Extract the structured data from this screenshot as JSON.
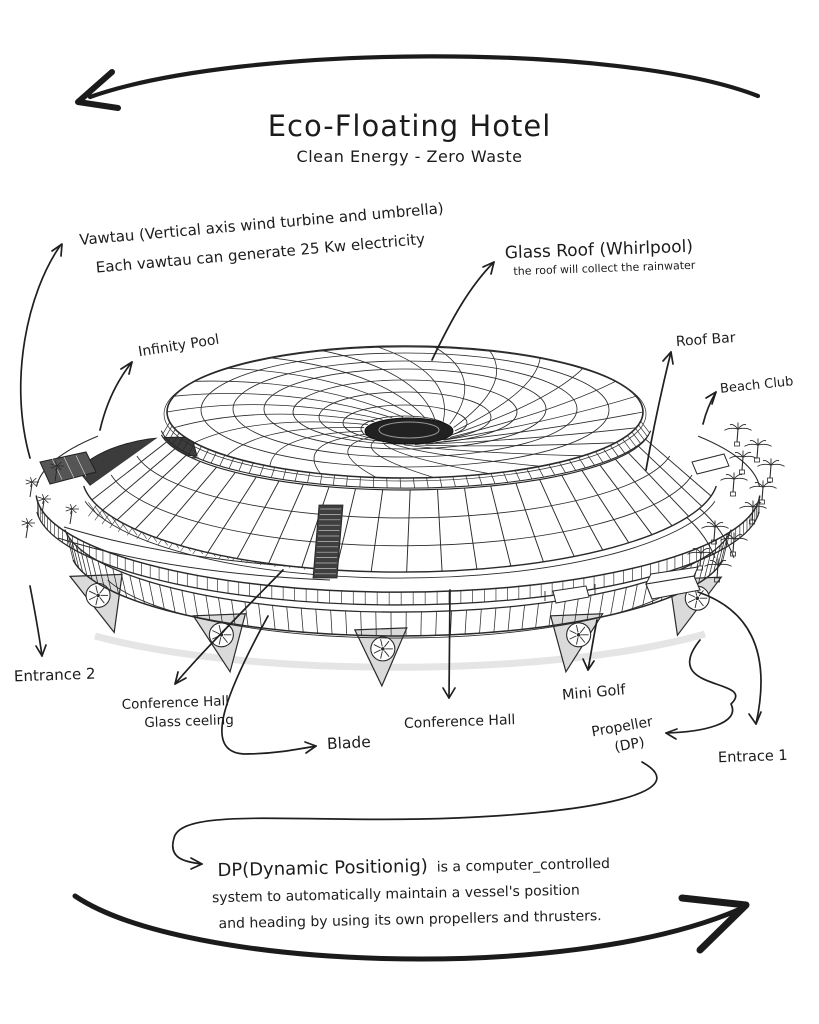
{
  "colors": {
    "ink": "#1c1c1c",
    "paper": "#ffffff",
    "dark_shade": "#3c3c3c"
  },
  "header": {
    "title": "Eco-Floating Hotel",
    "subtitle": "Clean Energy - Zero Waste"
  },
  "annotations": {
    "vawtau": {
      "line1": "Vawtau (Vertical axis wind turbine and umbrella)",
      "line2": "Each vawtau can generate 25 Kw electricity"
    },
    "glass_roof": {
      "label": "Glass Roof (Whirlpool)",
      "note": "the roof will collect the rainwater"
    },
    "infinity_pool": {
      "label": "Infinity Pool"
    },
    "roof_bar": {
      "label": "Roof Bar"
    },
    "beach_club": {
      "label": "Beach Club"
    },
    "entrance_2": {
      "label": "Entrance 2"
    },
    "conference_hall_glass": {
      "line1": "Conference Hall",
      "line2": "Glass ceeling"
    },
    "blade": {
      "label": "Blade"
    },
    "conference_hall": {
      "label": "Conference Hall"
    },
    "mini_golf": {
      "label": "Mini Golf"
    },
    "propeller": {
      "line1": "Propeller",
      "line2": "(DP)"
    },
    "entrance_1": {
      "label": "Entrace 1"
    },
    "dp_note": {
      "intro": "DP(Dynamic Positionig)",
      "line1_rest": "is a computer_controlled",
      "line2": "system to automatically maintain a vessel's position",
      "line3": "and heading by using its own propellers and thrusters."
    }
  }
}
